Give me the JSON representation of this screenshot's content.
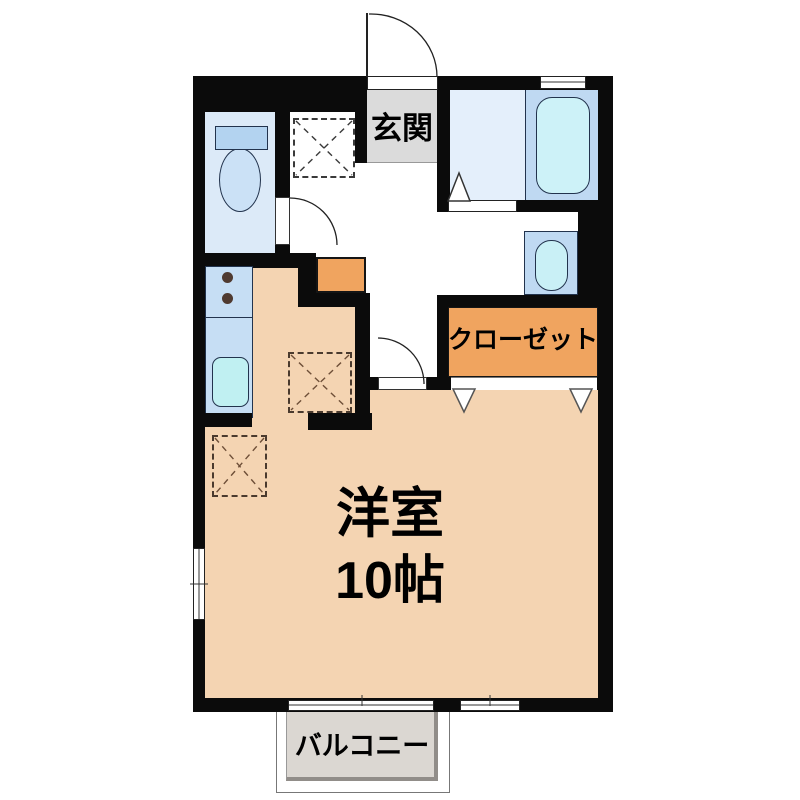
{
  "plan": {
    "title": "1R apartment floor plan",
    "labels": {
      "entrance": "玄関",
      "closet": "クローゼット",
      "room_name": "洋室",
      "room_size": "10帖",
      "balcony": "バルコニー"
    },
    "colors": {
      "wall": "#0b0b0b",
      "room_floor_tan": "#F4D4B2",
      "accent_orange": "#F0A45F",
      "entrance_floor_gray": "#DBDBDB",
      "balcony_floor_gray": "#DBD7D2",
      "toilet_floor": "#DCEAF8",
      "bathroom_floor": "#E4EFFB",
      "fixture_panel_blue": "#BFD9F2",
      "water_cyan": "#CDF2F8",
      "burner_brown": "#4F3A30"
    }
  }
}
